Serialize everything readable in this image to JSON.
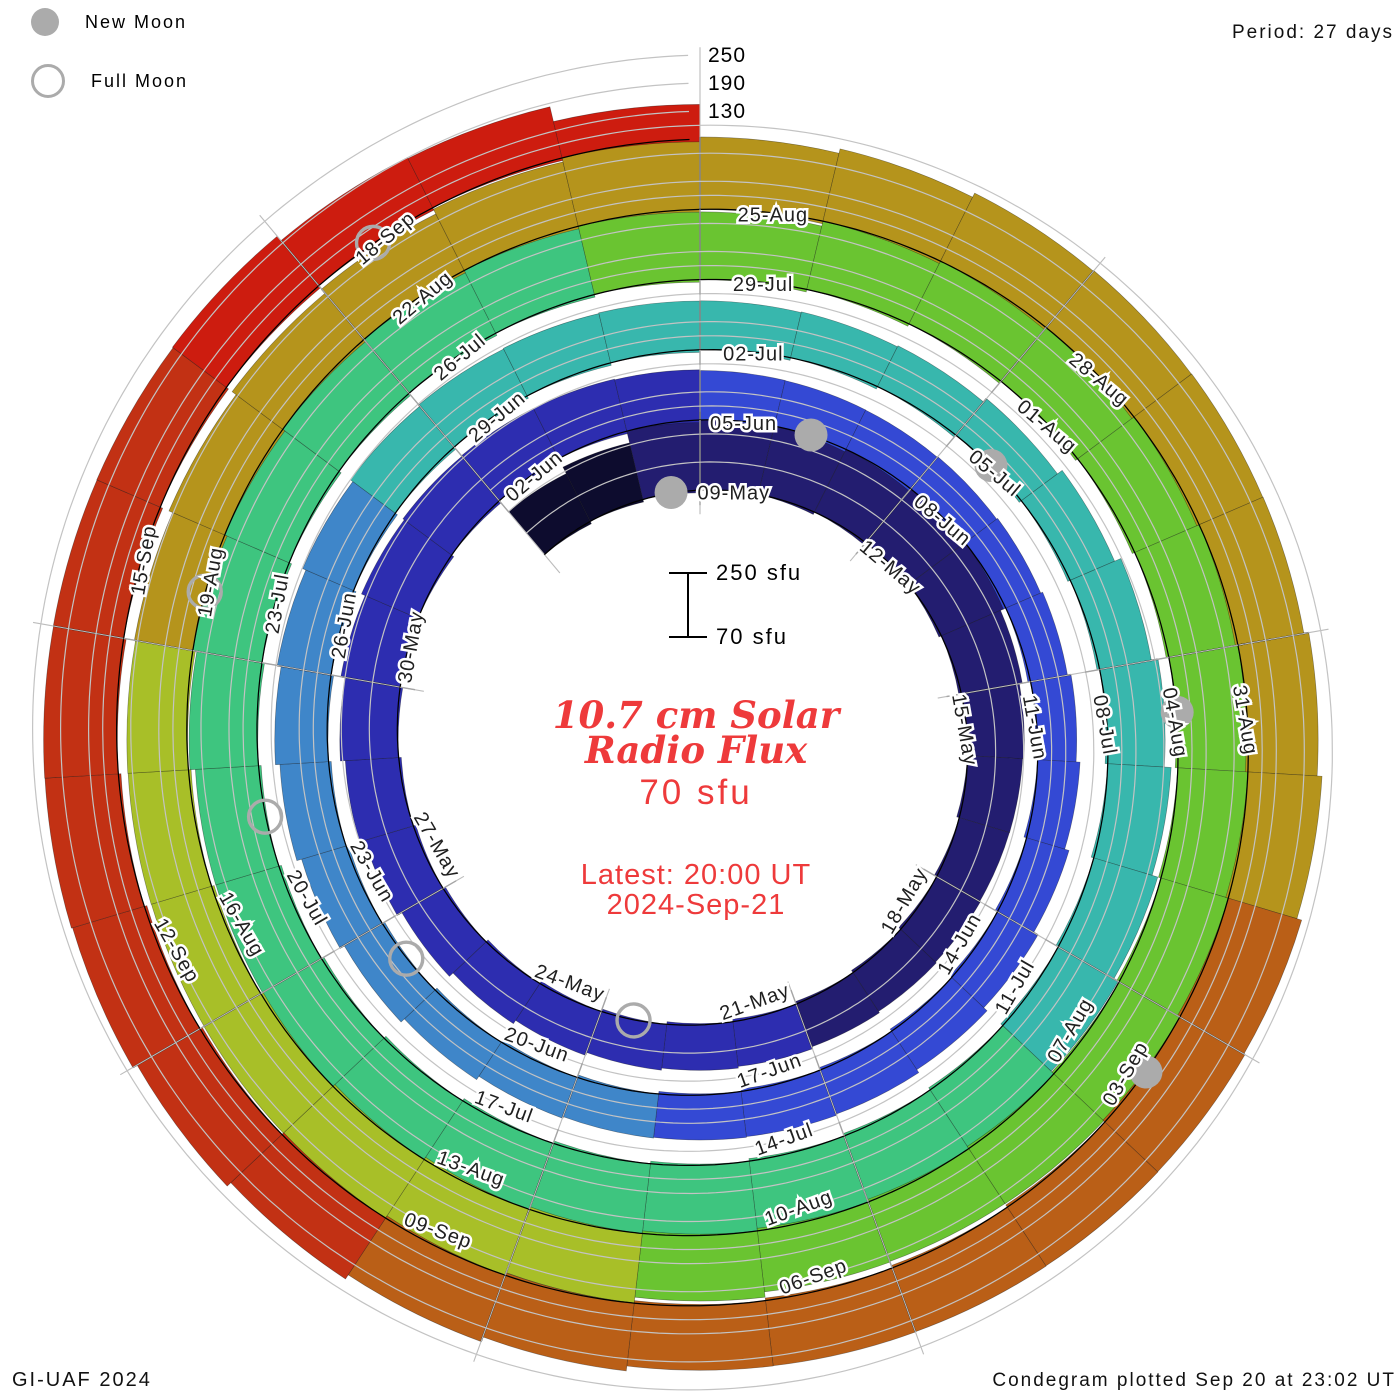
{
  "legend": {
    "new_moon": "New Moon",
    "full_moon": "Full Moon"
  },
  "period_label": "Period: 27 days",
  "credits": {
    "bottom_left": "GI-UAF 2024",
    "bottom_right": "Condegram plotted Sep 20 at 23:02 UT"
  },
  "center": {
    "title_line1": "10.7 cm Solar",
    "title_line2": "Radio Flux",
    "flux_value": "70 sfu",
    "latest_line1": "Latest: 20:00 UT",
    "latest_line2": "2024-Sep-21"
  },
  "scale_bar": {
    "top_label": "250 sfu",
    "bottom_label": "70 sfu"
  },
  "colors": {
    "accent_red_text": "#ee3a3b",
    "moon_gray": "#ababab",
    "gridline_gray": "#c3c3c3",
    "tick_gray": "#a5a5a5",
    "label_ink": "#1f1f1f"
  },
  "chart_data": {
    "type": "bar",
    "subtype": "polar-spiral-condegram",
    "title": "10.7 cm Solar Radio Flux",
    "start_date": "2024-05-06",
    "end_date": "2024-09-21",
    "period_days": 27,
    "flux_axis_ticks": [
      130,
      190,
      250
    ],
    "flux_range": [
      70,
      250
    ],
    "date_labels": [
      "09-May",
      "12-May",
      "15-May",
      "18-May",
      "21-May",
      "24-May",
      "27-May",
      "30-May",
      "02-Jun",
      "05-Jun",
      "08-Jun",
      "11-Jun",
      "14-Jun",
      "17-Jun",
      "20-Jun",
      "23-Jun",
      "26-Jun",
      "29-Jun",
      "02-Jul",
      "05-Jul",
      "08-Jul",
      "11-Jul",
      "14-Jul",
      "17-Jul",
      "20-Jul",
      "23-Jul",
      "26-Jul",
      "29-Jul",
      "01-Aug",
      "04-Aug",
      "07-Aug",
      "10-Aug",
      "13-Aug",
      "16-Aug",
      "19-Aug",
      "22-Aug",
      "25-Aug",
      "28-Aug",
      "31-Aug",
      "03-Sep",
      "06-Sep",
      "09-Sep",
      "12-Sep",
      "15-Sep",
      "18-Sep"
    ],
    "first_label_day_index": 3,
    "label_step_days": 3,
    "values_sfu_daily": [
      190,
      200,
      225,
      238,
      245,
      242,
      235,
      222,
      208,
      196,
      188,
      182,
      178,
      175,
      173,
      172,
      170,
      169,
      170,
      173,
      178,
      184,
      190,
      195,
      199,
      202,
      200,
      196,
      190,
      183,
      176,
      170,
      164,
      160,
      157,
      156,
      158,
      161,
      165,
      170,
      174,
      176,
      173,
      169,
      165,
      163,
      166,
      170,
      175,
      180,
      184,
      187,
      189,
      190,
      188,
      184,
      180,
      175,
      171,
      168,
      172,
      179,
      188,
      197,
      206,
      213,
      218,
      223,
      227,
      225,
      221,
      228,
      234,
      230,
      223,
      216,
      211,
      217,
      224,
      229,
      233,
      231,
      226,
      220,
      215,
      221,
      228,
      233,
      237,
      240,
      236,
      232,
      228,
      223,
      217,
      211,
      207,
      213,
      220,
      226,
      222,
      216,
      210,
      205,
      200,
      197,
      200,
      205,
      211,
      217,
      221,
      225,
      229,
      233,
      229,
      224,
      219,
      224,
      229,
      234,
      231,
      226,
      221,
      216,
      211,
      216,
      221,
      226,
      231,
      236,
      233,
      228,
      223,
      218,
      214,
      196,
      188,
      150
    ],
    "color_bins": [
      {
        "start_day": 0,
        "color": "#0d0c2e"
      },
      {
        "start_day": 2,
        "color": "#231d70"
      },
      {
        "start_day": 15,
        "color": "#2d2db0"
      },
      {
        "start_day": 30,
        "color": "#3449d4"
      },
      {
        "start_day": 44,
        "color": "#3f86c9"
      },
      {
        "start_day": 53,
        "color": "#38b7ad"
      },
      {
        "start_day": 67,
        "color": "#3ec57f"
      },
      {
        "start_day": 83,
        "color": "#6ac431"
      },
      {
        "start_day": 98,
        "color": "#a8bf28"
      },
      {
        "start_day": 105,
        "color": "#b5941c"
      },
      {
        "start_day": 119,
        "color": "#ba5f17"
      },
      {
        "start_day": 127,
        "color": "#c23114"
      },
      {
        "start_day": 134,
        "color": "#cd1c0f"
      }
    ],
    "moons": {
      "new_moon_days": [
        2,
        31,
        60,
        90,
        120
      ],
      "full_moon_days": [
        17,
        47,
        76,
        105,
        135
      ],
      "new_moon_dates": [
        "2024-05-08",
        "2024-06-06",
        "2024-07-05",
        "2024-08-04",
        "2024-09-03"
      ],
      "full_moon_dates": [
        "2024-05-23",
        "2024-06-22",
        "2024-07-21",
        "2024-08-19",
        "2024-09-18"
      ]
    },
    "layout": {
      "center_x": 700,
      "center_y": 740,
      "base_radius": 242,
      "radius_per_day": 2.6,
      "deg_per_day": 13.333333,
      "px_per_sfu": 0.4672,
      "grid_on": true,
      "legend_position": "top-left",
      "scale_bar": {
        "x": 688,
        "y_top": 573,
        "y_bottom": 637,
        "cap_half": 19,
        "label_x": 716,
        "top_label_y": 580,
        "bottom_label_y": 644
      }
    }
  }
}
